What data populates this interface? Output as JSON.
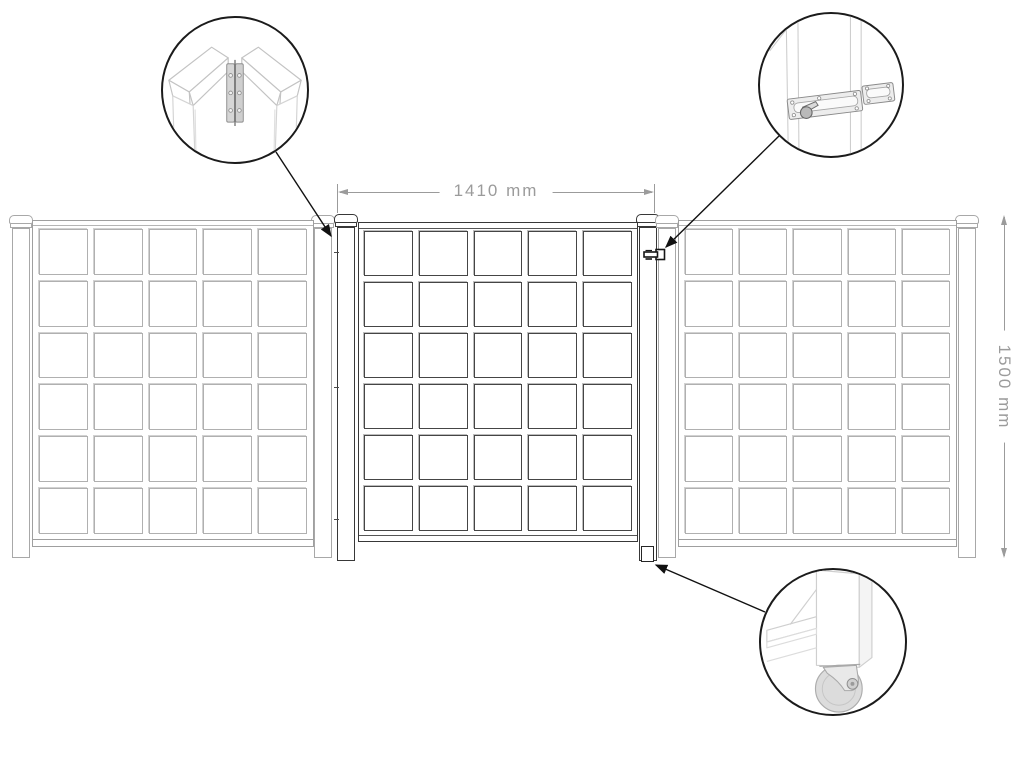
{
  "diagram": {
    "name": "fence-and-gate-assembly-diagram",
    "dimensions": {
      "width_label": "1410 mm",
      "height_label": "1500 mm"
    },
    "panels": [
      {
        "id": "left-fence-panel",
        "style": "fence",
        "grid": {
          "rows": 6,
          "cols": 5
        }
      },
      {
        "id": "gate-panel",
        "style": "gate",
        "grid": {
          "rows": 6,
          "cols": 5
        }
      },
      {
        "id": "right-fence-panel",
        "style": "fence",
        "grid": {
          "rows": 6,
          "cols": 5
        }
      }
    ],
    "details": [
      {
        "id": "hinge-detail",
        "icon": "hinge-icon"
      },
      {
        "id": "latch-detail",
        "icon": "barrel-bolt-icon"
      },
      {
        "id": "caster-detail",
        "icon": "caster-wheel-icon"
      }
    ],
    "colors": {
      "fence_line": "#a8a8a8",
      "gate_line": "#383838",
      "dimension_line": "#9b9b9b",
      "callout_line": "#1b1b1b"
    }
  }
}
